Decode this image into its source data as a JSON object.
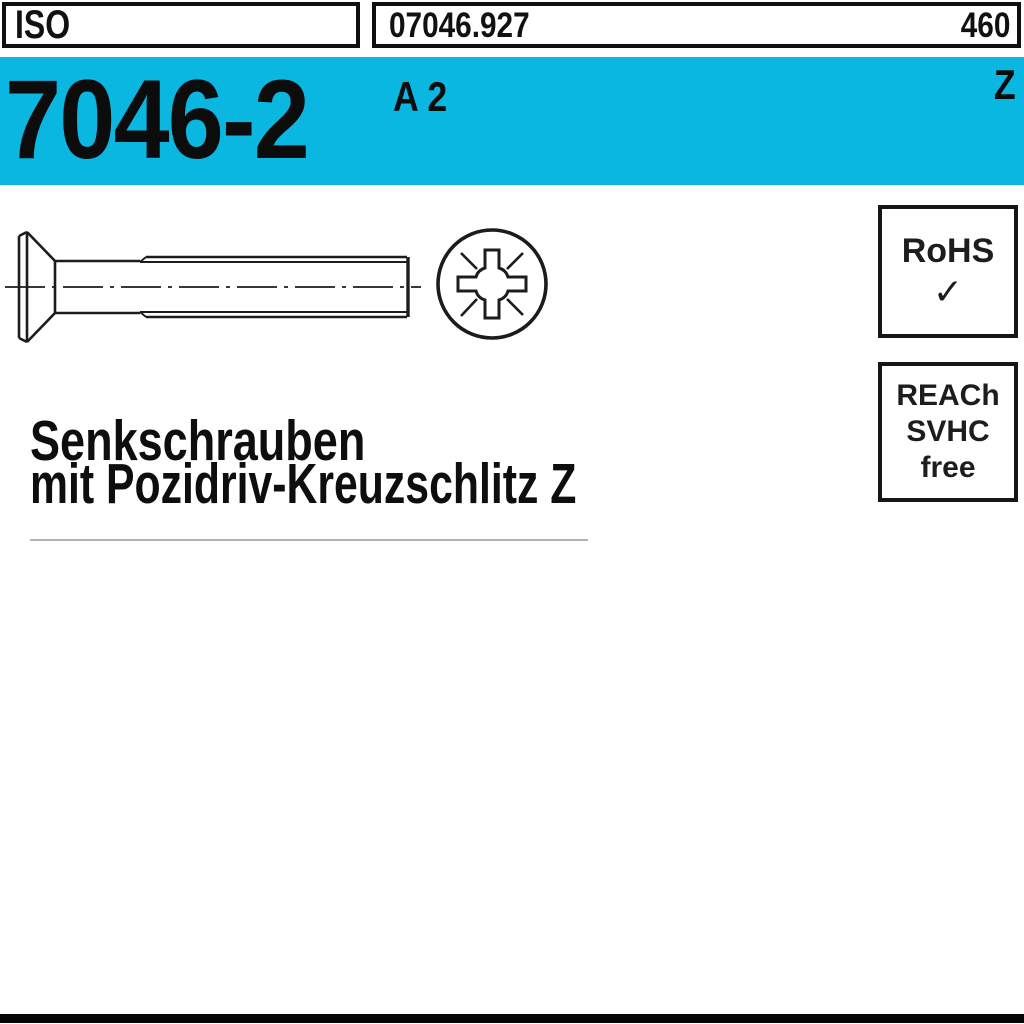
{
  "header": {
    "org": "ISO",
    "article_number": "07046.927",
    "page": "460"
  },
  "banner": {
    "standard": "7046-2",
    "material": "A 2",
    "drive": "Z"
  },
  "badges": {
    "rohs": {
      "label": "RoHS",
      "check_icon": "✓"
    },
    "reach": {
      "line1": "REACh",
      "line2": "SVHC",
      "line3": "free"
    }
  },
  "title": {
    "line1": "Senkschrauben",
    "line2": "mit Pozidriv-Kreuzschlitz Z"
  },
  "colors": {
    "banner_cyan": "#09B7E0",
    "line_black": "#1c1c1c"
  }
}
